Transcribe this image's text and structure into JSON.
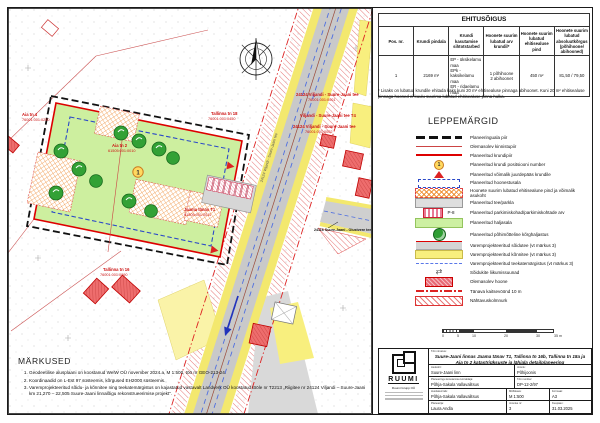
{
  "ehitusoigus": {
    "title": "EHITUSÕIGUS",
    "headers": [
      "Pos. nr.",
      "Krundi pindala",
      "Krundi kasutamise sihtotstarbed",
      "Hoonete suurim lubatud arv krundil*",
      "Hoonete suurim lubatud ehitisealuse pind",
      "Hoonete suurim lubatud absoluutkõrgus (põhihoone/ abihooned)"
    ],
    "row": {
      "pos": "1",
      "pindala": "2169 m²",
      "sihtotstarbed": [
        "EP - üksikelamu maa",
        "EPk - kaksikelamu maa",
        "ER - ridaelamu maa"
      ],
      "arv": [
        "1 põhihoone",
        "2 abihoonet"
      ],
      "pind": "450 m²",
      "korgus": "81,50 / 79,50"
    },
    "footnote": "* Lisaks on lubatud krundile ehitada kaks kuni 20 m² ehitisealuse pinnaga abihoonet. Kuni 20 m² ehitisealuse pinnaga hooned ei kuulu suurima lubatud ehitisealuse pinna hulka."
  },
  "legend": {
    "title": "LEPPEMÄRGID",
    "pos_symbol": "1",
    "parking_label": "P-8",
    "arrows_glyph": "⇄",
    "items": [
      {
        "label": "Planeeringuala piir"
      },
      {
        "label": "Olemasolev kinnistupiir"
      },
      {
        "label": "Planeeritud krundipiir"
      },
      {
        "label": "Planeeritud krundi positsiooni number"
      },
      {
        "label": "Planeeritud võimalik juurdepääs krundile"
      },
      {
        "label": "Planeeritud hoonestusala"
      },
      {
        "label": "Hoonete suurim lubatud ehitisealune pind ja võimalik asukoht"
      },
      {
        "label": "Planeeritud tee/parkla"
      },
      {
        "label": "Planeeritud parkimiskohad/parkimiskohtade arv"
      },
      {
        "label": "Planeeritud haljasala"
      },
      {
        "label": "Planeeritud põhimõtteline kõrghaljastus"
      },
      {
        "label": "Varemprojekteeritud sõidutee (vt märkus 3)"
      },
      {
        "label": "Varemprojekteeritud kõnnitee (vt märkus 3)"
      },
      {
        "label": "Varemprojekteeritud teekatemärgistus (vt märkus 3)"
      },
      {
        "label": "Sõidukite liikumissuunad"
      },
      {
        "label": "Olemasolev hoone"
      },
      {
        "label": "Tänava kaitsevöönd 10 m"
      },
      {
        "label": "Nähtavuskolmnurk"
      }
    ]
  },
  "scalebar": {
    "ticks": [
      "0",
      "5",
      "10",
      "20",
      "30",
      "35 m"
    ]
  },
  "notes": {
    "title": "MÄRKUSED",
    "items": [
      "Geodeetilise alusplaani on koostanud WelW OÜ november 2024.a, M 1:500, töö nr GEO-213-24.",
      "Koordinaadid on L-Est 97 süsteemis, kõrgused EH2000 süsteemis.",
      "Varemprojekteeritud sõidu- ja kõnnitee ning teekatemärgistus on kajastatud vastavalt Landverk OÜ koostatud tööle nr T2213 „Riigitee nr 24124 Viljandi – Suure-Jaani km 21,270 – 22,505 Suure-Jaani linnalõigu rekonstrueerimise projekt“."
    ]
  },
  "titleblock": {
    "company_logo_text": "RUUMI",
    "company_name": "Ruumi Grupp OÜ",
    "project_label": "Töö nimetus:",
    "project_title": "Suure-Jaani linnas Jaama tänav T1, Tallinna tn 16b, Tallinna tn 18a ja Aia tn 2 katastriüksuste ja lähiala detailplaneering",
    "fields": [
      {
        "label": "Asukoht:",
        "value": "Suure-Jaani linn"
      },
      {
        "label": "Joonis:",
        "value": "Põhijoonis"
      },
      {
        "label": "Planeeringu koostamise korraldaja:",
        "value": "Põhja-Sakala Vallavalitsus"
      },
      {
        "label": "Töö number:",
        "value": "DP-12-2/97"
      },
      {
        "label": "Huvitatud isik:",
        "value": "Põhja-Sakala Vallavalitsus"
      },
      {
        "label": "Mõõtkava:",
        "value": "M 1:500"
      },
      {
        "label": "Formaat:",
        "value": "A3"
      },
      {
        "label": "Planeerija:",
        "value": "Laura Andla"
      },
      {
        "label": "Joonise nr:",
        "value": "3"
      },
      {
        "label": "Kuupäev:",
        "value": "31.03.2025"
      }
    ]
  },
  "map": {
    "road_label": "24116 Suure-Jaani - Olustvere tee",
    "road_label_rotated": "24124 Viljandi - Suure-Jaani tee",
    "pos_number": "1",
    "labels": [
      {
        "text": "Aia tn 4",
        "code": "76001:001:0250"
      },
      {
        "text": "Tallinna tn 18",
        "code": "76001:001:0450"
      },
      {
        "text": "Aia tn 2",
        "code": "61505:001:0010"
      },
      {
        "text": "Jaama tänav T1",
        "code": "61505:001:0011"
      },
      {
        "text": "Tallinna tn 16",
        "code": "76001:001:0090"
      },
      {
        "text": "24124 Viljandi - Suure-Jaani tee",
        "code": "76001:001:0001"
      },
      {
        "text": "Viljandi - Suure-Jaani tee T4",
        "code": ""
      },
      {
        "text": "24124 Viljandi - Suure-Jaani tee",
        "code": "76001:001:0002"
      }
    ]
  },
  "colors": {
    "plot_green": "#cdef9f",
    "road_gray": "#c9c9c9",
    "sidewalk_yellow": "#f8ef7e",
    "boundary_red": "#dd0000",
    "hoonestusala_blue": "#2b49c8"
  }
}
